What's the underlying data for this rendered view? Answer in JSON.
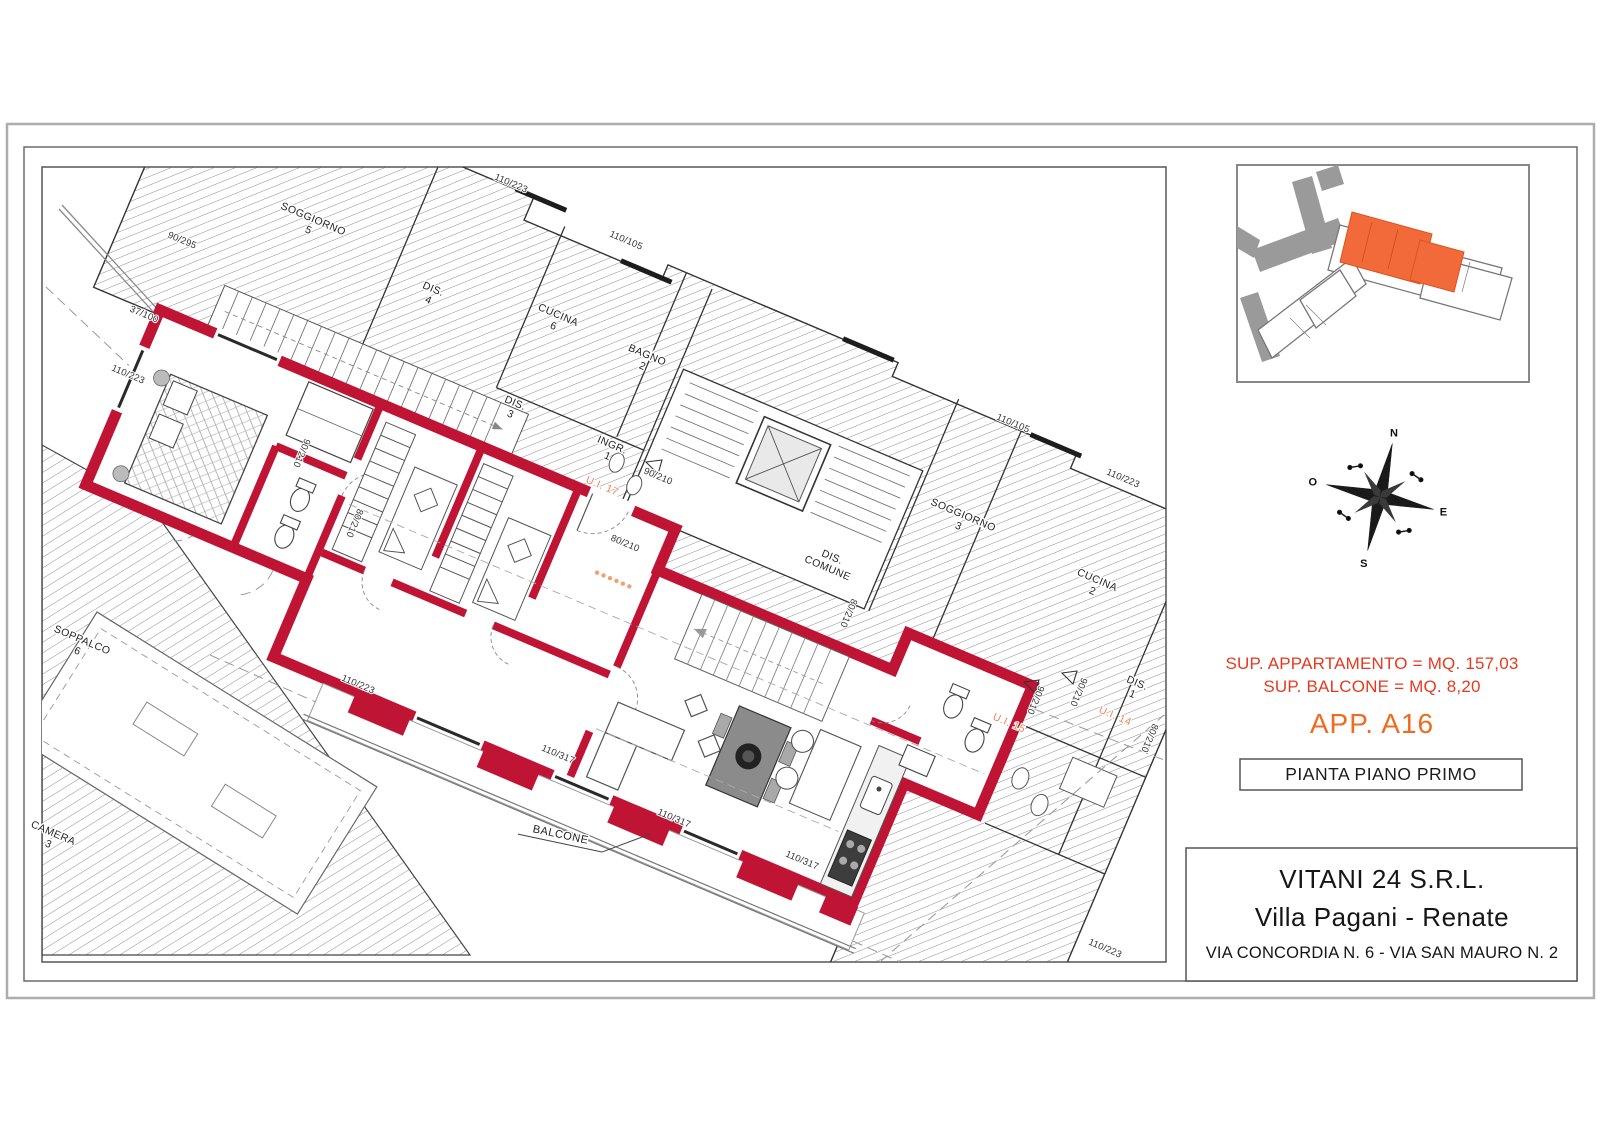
{
  "plan": {
    "wall_color": "#c01434",
    "highlight_color": "#f26a3a",
    "rooms": [
      {
        "lines": [
          "SOGGIORNO",
          "5"
        ]
      },
      {
        "lines": [
          "DIS.",
          "4"
        ]
      },
      {
        "lines": [
          "CUCINA",
          "6"
        ]
      },
      {
        "lines": [
          "BAGNO",
          "2"
        ]
      },
      {
        "lines": [
          "DIS.",
          "3"
        ]
      },
      {
        "lines": [
          "INGR.",
          "1"
        ]
      },
      {
        "lines": [
          "SOGGIORNO",
          "3"
        ]
      },
      {
        "lines": [
          "DIS.",
          "COMUNE"
        ]
      },
      {
        "lines": [
          "CUCINA",
          "2"
        ]
      },
      {
        "lines": [
          "DIS.",
          "1"
        ]
      },
      {
        "lines": [
          "SOPPALCO",
          "6"
        ]
      },
      {
        "lines": [
          "CAMERA",
          "3"
        ]
      }
    ],
    "unit_labels": [
      "U.I. 17",
      "U.I. 15",
      "U.I. 14"
    ],
    "balcony_label": "BALCONE",
    "dimensions": [
      "110/223",
      "90/295",
      "110/105",
      "110/105",
      "110/223",
      "37/100",
      "110/223",
      "90/210",
      "80/210",
      "110/223",
      "110/317",
      "110/317",
      "110/317",
      "110/223",
      "80/210",
      "80/210",
      "80/210",
      "90/210",
      "90/210",
      "90/210"
    ]
  },
  "compass": {
    "n": "N",
    "e": "E",
    "s": "S",
    "o": "O"
  },
  "info": {
    "surface_apartment": "SUP. APPARTAMENTO = MQ. 157,03",
    "surface_balcony": "SUP. BALCONE = MQ. 8,20",
    "apartment_code": "APP. A16",
    "drawing_title": "PIANTA PIANO PRIMO",
    "accent_red": "#e63a20",
    "accent_orange": "#f06a22"
  },
  "title_block": {
    "company": "VITANI 24 S.R.L.",
    "project": "Villa Pagani - Renate",
    "address": "VIA CONCORDIA N. 6 - VIA SAN MAURO N. 2"
  }
}
